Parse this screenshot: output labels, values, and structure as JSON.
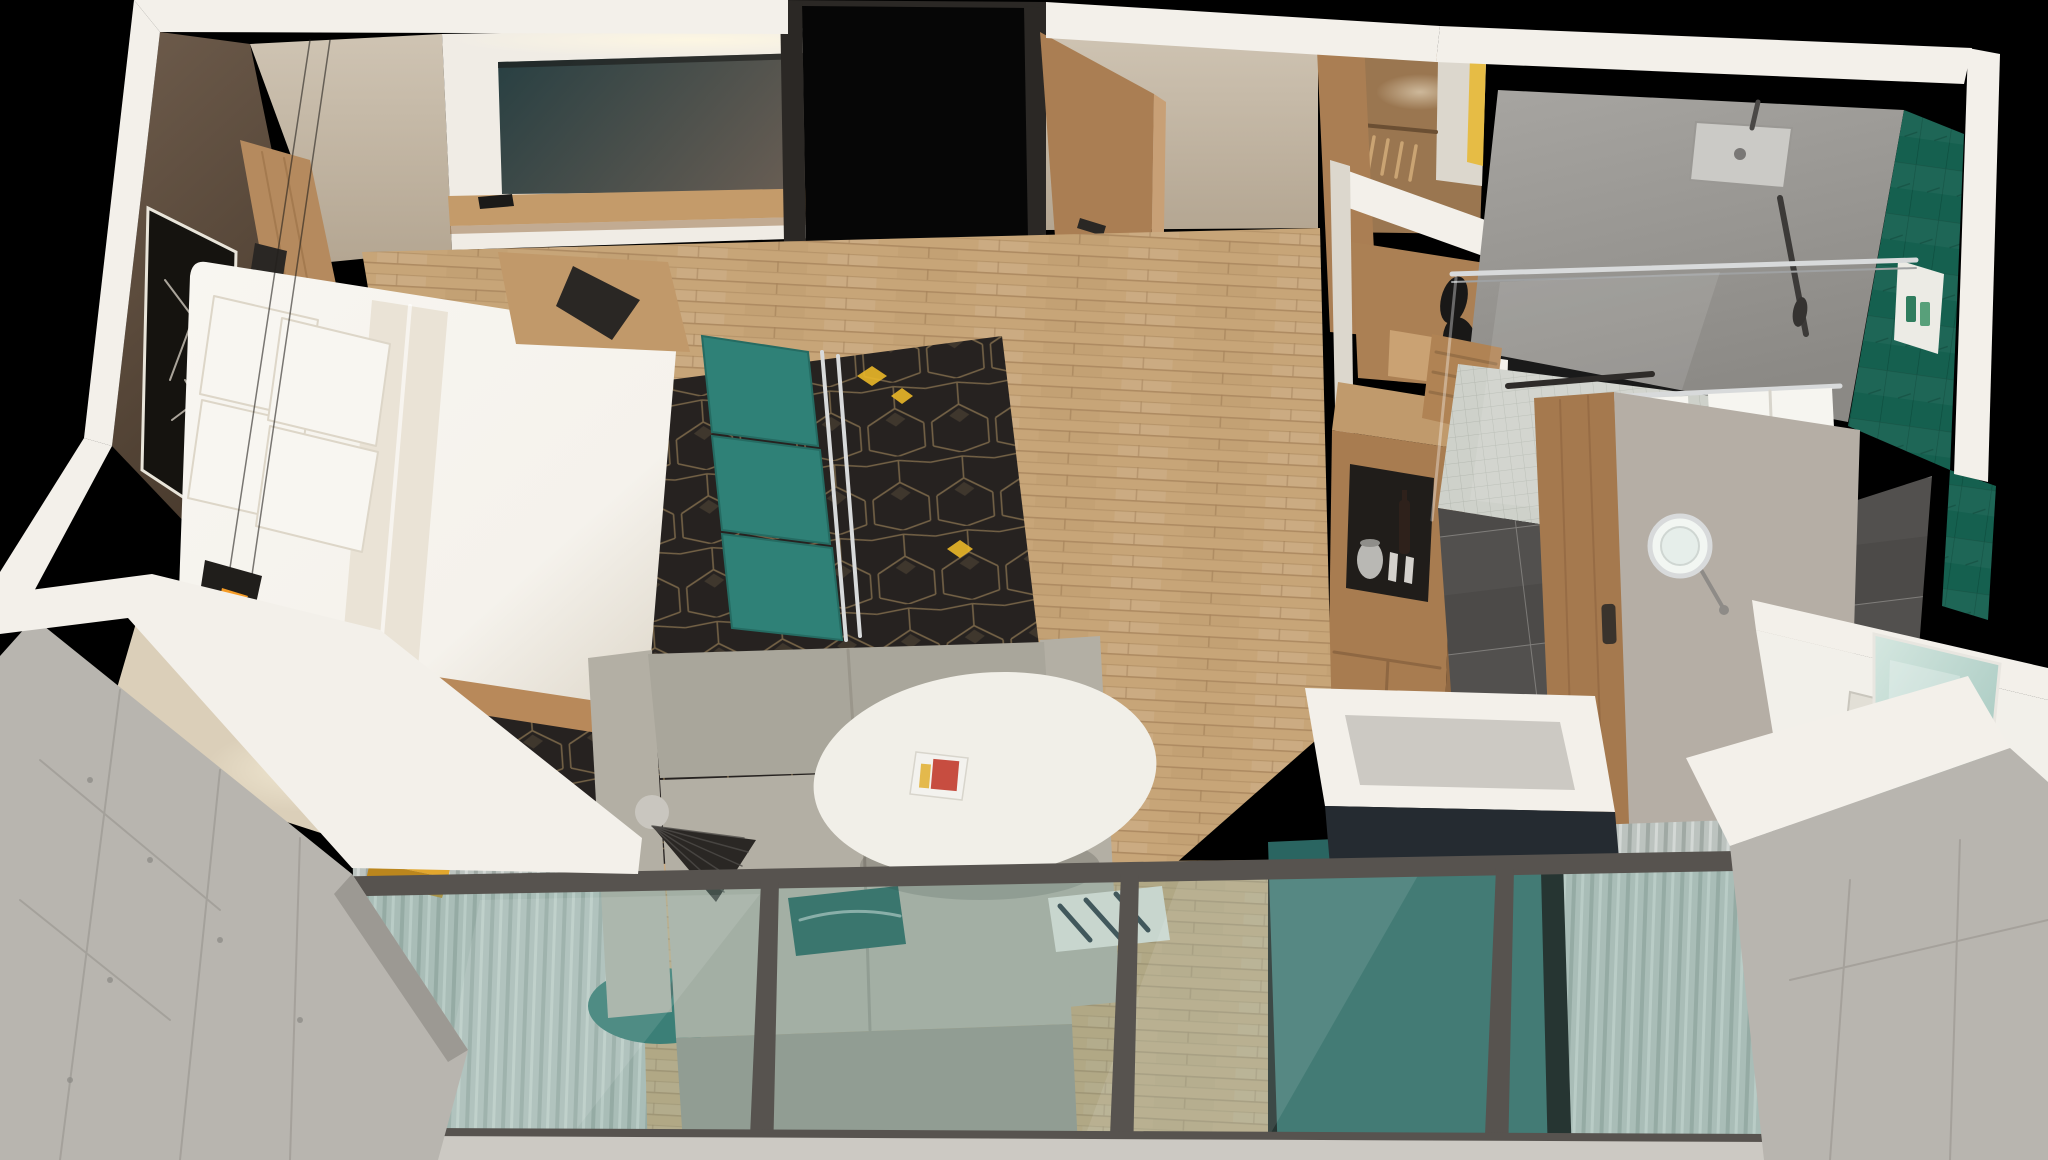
{
  "scene": {
    "title": "3D isometric cutaway rendering of a hotel guest room suite with bedroom, living area, entry, closet and bathroom",
    "type": "architectural-render",
    "view": "top-down isometric dollhouse",
    "background": "black"
  },
  "colors": {
    "bg": "#000000",
    "wall_cut": "#f3f0ea",
    "wall_cut_shade": "#dcd7cd",
    "wall_beige": "#cfc4b3",
    "wall_beige_dark": "#b4a692",
    "wall_brown_light": "#6e5c4c",
    "wall_brown_dark": "#433528",
    "headboard_wood": "#b58a5e",
    "headboard_shadow": "#93693f",
    "art_black": "#15130f",
    "art_line": "#cfc9bd",
    "tv_panel": "#f0ece5",
    "tv_screen_start": "#273f42",
    "tv_screen_end": "#6e6055",
    "shelf_wood": "#c49b6a",
    "remote_black": "#1b1a18",
    "bed_white": "#f5f2ec",
    "bed_shade": "#dcd5c7",
    "duvet_silk": "#eae3d6",
    "pillow_white": "#f8f6f1",
    "bed_base": "#b8895a",
    "rug_base": "#262220",
    "rug_line": "#8d7652",
    "rug_gold": "#eab728",
    "wood_floor": "#c7a578",
    "wood_plank_dark": "#a8855c",
    "bench_teal": "#2f8177",
    "bench_teal_dark": "#256b62",
    "chrome": "#d8dadb",
    "pendant_black": "#201e1b",
    "pendant_glow": "#f49b26",
    "lamp_black": "#2a2724",
    "desk_surface": "#dbcfb9",
    "desk_glow": "#f7edd2",
    "chair_yellow": "#e2a72e",
    "chair_yellow_dark": "#bb861d",
    "nightstand_wood": "#c1996a",
    "concrete": "#b8b5af",
    "concrete_dark": "#9c9993",
    "concrete_light": "#ccc9c3",
    "window_frame": "#57534f",
    "glass_tint": "rgba(125,176,166,0.30)",
    "glass_sheen": "rgba(255,255,255,0.10)",
    "curtain": "#bcc3bf",
    "curtain_dark": "#99a29e",
    "sofa_back": "#a9a69b",
    "sofa_seat": "#b3afa4",
    "sofa_front": "#9a968b",
    "pillow_teal": "#1e5e57",
    "pillow_pattern_base": "#e9e7e0",
    "pillow_pattern_navy": "#27333d",
    "table_white": "#f1efe8",
    "table_base": "#d8d4ca",
    "round_rug_teal": "#1f6b63",
    "navy_glass_panel": "#2a6561",
    "door_wood": "#aa7e53",
    "door_wood_edge": "#c8a076",
    "door_frame_black": "#2b2825",
    "opening_black": "#060606",
    "closet_wood": "#9a7650",
    "closet_yellow": "#e6ba3a",
    "hanger_wood": "#caa473",
    "alcove_wood": "#ab8054",
    "sculpture_black": "#191817",
    "cabinet_wood": "#a87c50",
    "cabinet_wood_dark": "#8e6742",
    "cabinet_wood_top": "#c09a6c",
    "niche_black": "#201d1a",
    "kettle_gray": "#b9b8b4",
    "wine_bottle": "#2e211b",
    "shower_wall_start": "#a7a5a1",
    "shower_wall_end": "#8b8985",
    "teal_wall": "#15604f",
    "teal_wall_line": "#0d4a3b",
    "mosaic_floor": "#ced1ca",
    "mosaic_line": "#b6bab2",
    "bath_tile": "#4c4a48",
    "bath_grout": "#7b7976",
    "towel_white": "#f6f5f0",
    "barn_wood": "#a5794e",
    "vanity_white": "#f2f0ea",
    "sink_inset": "#e2dfd6",
    "mirror_start": "#d5e7e0",
    "mirror_end": "#9ec3ba",
    "bath_wall_gray": "#b5aea5",
    "magazine_white": "#f3f2ee",
    "magazine_red": "#c23b2c",
    "glow_warm": "#ffdf9e"
  },
  "rooms": [
    {
      "name": "bedroom",
      "items": [
        "king bed with white duvet and four pillows",
        "wood headboard wall panel on dark brown accent wall",
        "black framed abstract artwork",
        "black faceted pendant light with amber glow",
        "floating wood nightstand with black phone",
        "lower nightstand with clock and black task lamp",
        "teal three-cushion bench with chrome frame",
        "dark geometric area rug with gold cube lattice and yellow diamond accents",
        "built-in desk with yellow chair"
      ]
    },
    {
      "name": "living-area",
      "items": [
        "light sage fabric sofa with teal pillow and patterned pillow",
        "white oval coffee table with open magazine",
        "black fan-shade floor lamp",
        "round teal accent rug",
        "light oak plank flooring"
      ]
    },
    {
      "name": "entry",
      "items": [
        "open wood entry door with black frame and handle",
        "wall-mounted flat screen TV on white recessed panel",
        "wood media shelf with remote control",
        "cove ceiling light"
      ]
    },
    {
      "name": "closet-and-casework",
      "items": [
        "open wardrobe with wood hangers, white shelf and yellow accent panel",
        "display alcove with black figurine sculpture",
        "minibar cabinet tower with dark niche holding kettle, glasses and wine bottle"
      ]
    },
    {
      "name": "bathroom",
      "items": [
        "walk-in shower with square rain head, hand shower and glass screen",
        "dark green vertical tile feature wall with toiletry niche",
        "white mosaic shower floor",
        "charcoal large-format tile floor",
        "sliding wood barn door",
        "lighted magnifying makeup mirror",
        "white vanity with basin, chrome faucet and framed mirror",
        "white towels on chrome bar",
        "teak shower bench"
      ]
    },
    {
      "name": "balcony-window-wall",
      "items": [
        "full-height glazing with dark gray frames and mullions",
        "sheer pleated curtains at both ends",
        "board-formed concrete structural columns",
        "navy half wall with concrete cap behind sofa",
        "exterior balcony slab"
      ]
    }
  ]
}
